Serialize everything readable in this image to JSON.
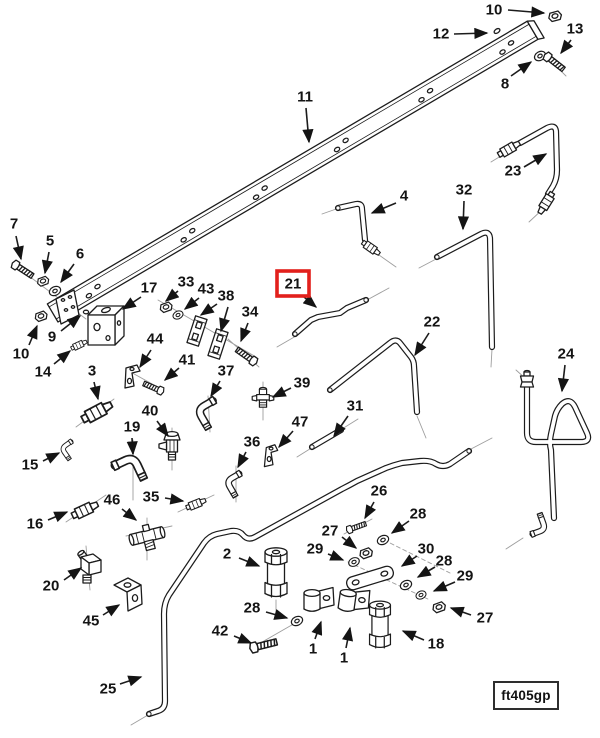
{
  "diagram": {
    "figure_code": "ft405gp",
    "highlight_color": "#e2201c",
    "ink_color": "#1c1c1c",
    "callouts": [
      {
        "label": "10",
        "x": 494,
        "y": 10,
        "arrows": [
          [
            508,
            10,
            544,
            13
          ]
        ]
      },
      {
        "label": "12",
        "x": 441,
        "y": 34,
        "arrows": [
          [
            454,
            34,
            487,
            33
          ]
        ]
      },
      {
        "label": "13",
        "x": 575,
        "y": 29,
        "arrows": [
          [
            571,
            40,
            561,
            53
          ]
        ]
      },
      {
        "label": "8",
        "x": 505,
        "y": 84,
        "arrows": [
          [
            511,
            76,
            531,
            62
          ]
        ]
      },
      {
        "label": "11",
        "x": 305,
        "y": 97,
        "arrows": [
          [
            306,
            108,
            309,
            142
          ]
        ]
      },
      {
        "label": "23",
        "x": 513,
        "y": 171,
        "arrows": [
          [
            524,
            167,
            546,
            154
          ]
        ]
      },
      {
        "label": "4",
        "x": 404,
        "y": 196,
        "arrows": [
          [
            396,
            203,
            372,
            213
          ]
        ]
      },
      {
        "label": "32",
        "x": 464,
        "y": 190,
        "arrows": [
          [
            464,
            201,
            463,
            229
          ]
        ]
      },
      {
        "label": "21",
        "x": 293,
        "y": 284,
        "boxed": true,
        "arrows": [
          [
            304,
            297,
            316,
            307
          ]
        ]
      },
      {
        "label": "22",
        "x": 432,
        "y": 322,
        "arrows": [
          [
            429,
            333,
            415,
            355
          ]
        ]
      },
      {
        "label": "24",
        "x": 566,
        "y": 354,
        "arrows": [
          [
            565,
            365,
            562,
            391
          ]
        ]
      },
      {
        "label": "7",
        "x": 14,
        "y": 224,
        "arrows": [
          [
            16,
            236,
            21,
            259
          ]
        ]
      },
      {
        "label": "5",
        "x": 50,
        "y": 241,
        "arrows": [
          [
            49,
            252,
            45,
            273
          ]
        ]
      },
      {
        "label": "6",
        "x": 80,
        "y": 254,
        "arrows": [
          [
            74,
            264,
            61,
            282
          ]
        ]
      },
      {
        "label": "17",
        "x": 149,
        "y": 288,
        "arrows": [
          [
            141,
            297,
            123,
            309
          ]
        ]
      },
      {
        "label": "33",
        "x": 186,
        "y": 282,
        "arrows": [
          [
            178,
            291,
            166,
            301
          ]
        ]
      },
      {
        "label": "43",
        "x": 206,
        "y": 289,
        "arrows": [
          [
            199,
            298,
            185,
            309
          ]
        ]
      },
      {
        "label": "38",
        "x": 226,
        "y": 296,
        "arrows": [
          [
            217,
            304,
            201,
            315
          ],
          [
            228,
            307,
            221,
            331
          ]
        ]
      },
      {
        "label": "34",
        "x": 250,
        "y": 312,
        "arrows": [
          [
            248,
            323,
            241,
            341
          ]
        ]
      },
      {
        "label": "9",
        "x": 52,
        "y": 337,
        "arrows": [
          [
            61,
            331,
            80,
            316
          ]
        ]
      },
      {
        "label": "10",
        "x": 21,
        "y": 354,
        "arrows": [
          [
            29,
            345,
            37,
            326
          ]
        ]
      },
      {
        "label": "14",
        "x": 43,
        "y": 372,
        "arrows": [
          [
            54,
            364,
            70,
            351
          ]
        ]
      },
      {
        "label": "44",
        "x": 155,
        "y": 339,
        "arrows": [
          [
            151,
            350,
            140,
            367
          ]
        ]
      },
      {
        "label": "41",
        "x": 187,
        "y": 360,
        "arrows": [
          [
            179,
            368,
            165,
            380
          ]
        ]
      },
      {
        "label": "37",
        "x": 226,
        "y": 371,
        "arrows": [
          [
            220,
            381,
            211,
            396
          ]
        ]
      },
      {
        "label": "39",
        "x": 302,
        "y": 383,
        "arrows": [
          [
            291,
            388,
            273,
            397
          ]
        ]
      },
      {
        "label": "3",
        "x": 92,
        "y": 371,
        "arrows": [
          [
            94,
            382,
            98,
            399
          ]
        ]
      },
      {
        "label": "40",
        "x": 150,
        "y": 411,
        "arrows": [
          [
            157,
            421,
            168,
            436
          ]
        ]
      },
      {
        "label": "19",
        "x": 132,
        "y": 427,
        "arrows": [
          [
            132,
            438,
            133,
            454
          ]
        ]
      },
      {
        "label": "15",
        "x": 30,
        "y": 465,
        "arrows": [
          [
            43,
            461,
            59,
            453
          ]
        ]
      },
      {
        "label": "36",
        "x": 252,
        "y": 442,
        "arrows": [
          [
            246,
            452,
            238,
            467
          ]
        ]
      },
      {
        "label": "47",
        "x": 300,
        "y": 422,
        "arrows": [
          [
            293,
            431,
            279,
            447
          ]
        ]
      },
      {
        "label": "31",
        "x": 355,
        "y": 406,
        "arrows": [
          [
            348,
            416,
            334,
            436
          ]
        ]
      },
      {
        "label": "35",
        "x": 151,
        "y": 497,
        "arrows": [
          [
            165,
            498,
            183,
            501
          ]
        ]
      },
      {
        "label": "46",
        "x": 112,
        "y": 500,
        "arrows": [
          [
            122,
            509,
            136,
            520
          ]
        ]
      },
      {
        "label": "16",
        "x": 35,
        "y": 524,
        "arrows": [
          [
            48,
            520,
            67,
            512
          ]
        ]
      },
      {
        "label": "20",
        "x": 51,
        "y": 586,
        "arrows": [
          [
            64,
            580,
            81,
            568
          ]
        ]
      },
      {
        "label": "45",
        "x": 91,
        "y": 621,
        "arrows": [
          [
            103,
            615,
            119,
            605
          ]
        ]
      },
      {
        "label": "2",
        "x": 227,
        "y": 554,
        "arrows": [
          [
            239,
            558,
            259,
            566
          ]
        ]
      },
      {
        "label": "26",
        "x": 379,
        "y": 491,
        "arrows": [
          [
            374,
            502,
            365,
            518
          ]
        ]
      },
      {
        "label": "27",
        "x": 330,
        "y": 531,
        "arrows": [
          [
            342,
            537,
            356,
            548
          ]
        ]
      },
      {
        "label": "29",
        "x": 315,
        "y": 549,
        "arrows": [
          [
            328,
            554,
            343,
            560
          ]
        ]
      },
      {
        "label": "28",
        "x": 252,
        "y": 608,
        "arrows": [
          [
            266,
            612,
            287,
            618
          ]
        ]
      },
      {
        "label": "42",
        "x": 220,
        "y": 631,
        "arrows": [
          [
            234,
            636,
            251,
            643
          ]
        ]
      },
      {
        "label": "1",
        "x": 313,
        "y": 649,
        "arrows": [
          [
            315,
            639,
            321,
            622
          ]
        ]
      },
      {
        "label": "1",
        "x": 344,
        "y": 658,
        "arrows": [
          [
            346,
            648,
            350,
            628
          ]
        ]
      },
      {
        "label": "18",
        "x": 436,
        "y": 644,
        "arrows": [
          [
            424,
            640,
            403,
            631
          ]
        ]
      },
      {
        "label": "30",
        "x": 426,
        "y": 549,
        "arrows": [
          [
            417,
            556,
            402,
            566
          ]
        ]
      },
      {
        "label": "28",
        "x": 418,
        "y": 514,
        "arrows": [
          [
            409,
            521,
            392,
            533
          ]
        ]
      },
      {
        "label": "28",
        "x": 444,
        "y": 561,
        "arrows": [
          [
            435,
            567,
            418,
            577
          ]
        ]
      },
      {
        "label": "29",
        "x": 465,
        "y": 576,
        "arrows": [
          [
            455,
            582,
            434,
            591
          ]
        ]
      },
      {
        "label": "27",
        "x": 485,
        "y": 618,
        "arrows": [
          [
            471,
            615,
            451,
            608
          ]
        ]
      },
      {
        "label": "25",
        "x": 108,
        "y": 689,
        "arrows": [
          [
            120,
            684,
            141,
            677
          ]
        ]
      }
    ]
  }
}
